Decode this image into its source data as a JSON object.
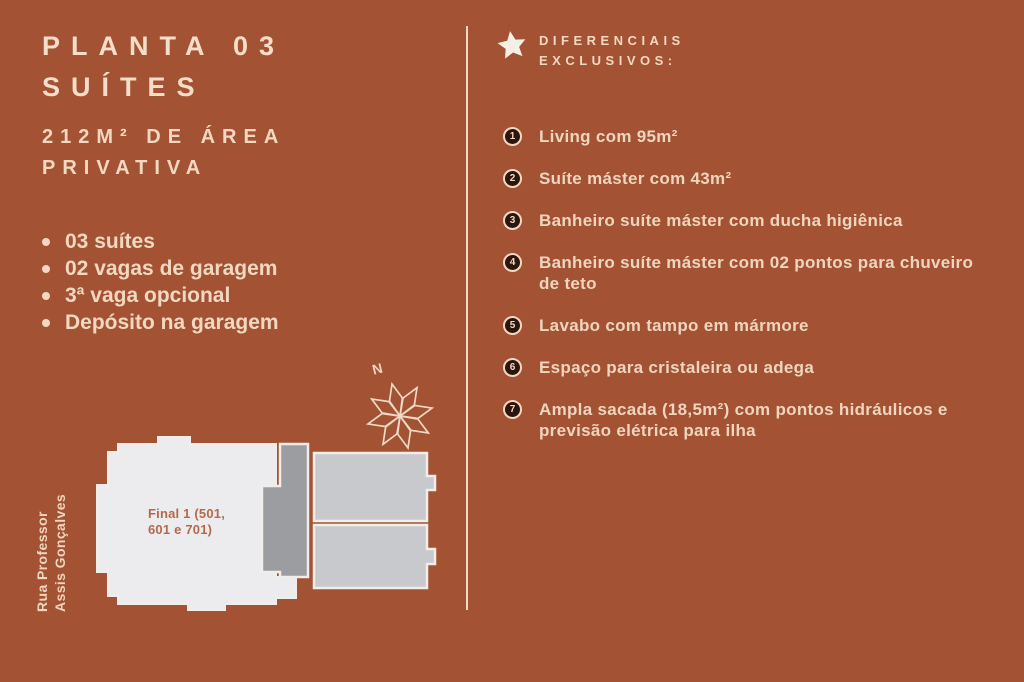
{
  "page": {
    "background_color": "#A35334",
    "text_color": "#F2D8C0"
  },
  "left": {
    "title_line1": "PLANTA 03",
    "title_line2": "SUÍTES",
    "subtitle_line1": "212M² DE ÁREA",
    "subtitle_line2": "PRIVATIVA",
    "bullets": [
      "03 suítes",
      "02 vagas de garagem",
      "3ª vaga opcional",
      "Depósito na garagem"
    ]
  },
  "floor_plan": {
    "street_label_line1": "Rua Professor",
    "street_label_line2": "Assis Gonçalves",
    "unit_label": "Final 1 (501,\n601 e 701)",
    "compass_label": "N",
    "colors": {
      "unit": "#ECECEE",
      "core": "#9B9DA0",
      "neighbor": "#C7C9CC",
      "outline": "#F2EDE8",
      "label": "#B5694C"
    }
  },
  "right": {
    "header_line1": "DIFERENCIAIS",
    "header_line2": "EXCLUSIVOS:",
    "items": [
      {
        "num": "1",
        "text": "Living com 95m²"
      },
      {
        "num": "2",
        "text": "Suíte máster com 43m²"
      },
      {
        "num": "3",
        "text": "Banheiro suíte máster com ducha higiênica"
      },
      {
        "num": "4",
        "text": "Banheiro suíte máster com 02 pontos para chuveiro de teto"
      },
      {
        "num": "5",
        "text": "Lavabo com tampo em mármore"
      },
      {
        "num": "6",
        "text": "Espaço para cristaleira ou adega"
      },
      {
        "num": "7",
        "text": "Ampla sacada (18,5m²) com pontos hidráulicos e previsão elétrica para ilha"
      }
    ]
  }
}
